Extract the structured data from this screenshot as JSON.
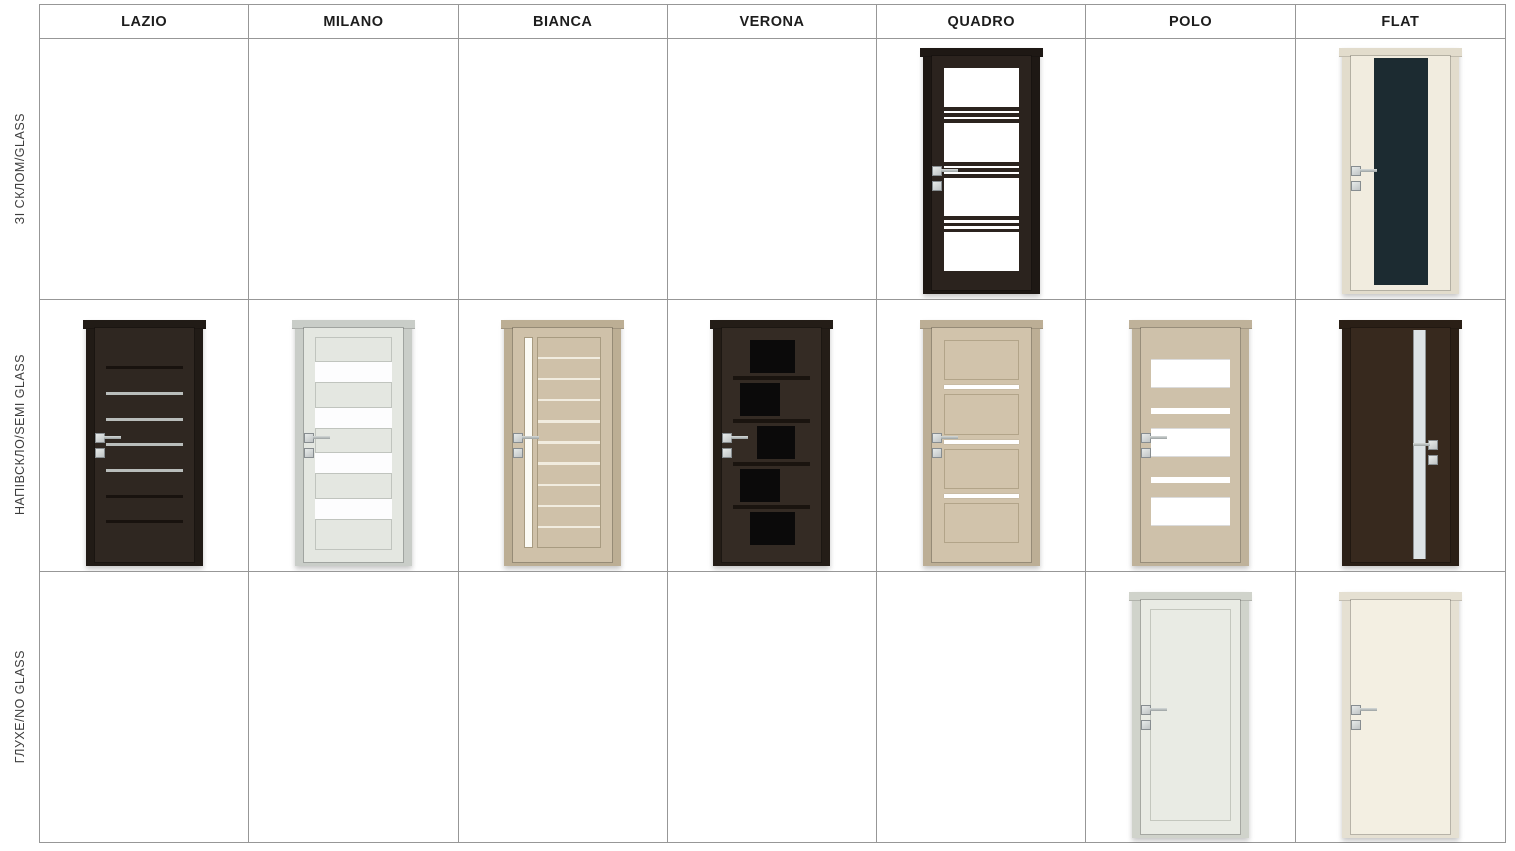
{
  "page": {
    "background": "#ffffff",
    "table_border": "#979797",
    "header_text_color": "#1d1d1d",
    "label_text_color": "#3d3d3d"
  },
  "table": {
    "columns": [
      {
        "key": "lazio",
        "label": "LAZIO"
      },
      {
        "key": "milano",
        "label": "MILANO"
      },
      {
        "key": "bianca",
        "label": "BIANCA"
      },
      {
        "key": "verona",
        "label": "VERONA"
      },
      {
        "key": "quadro",
        "label": "QUADRO"
      },
      {
        "key": "polo",
        "label": "POLO"
      },
      {
        "key": "flat",
        "label": "FLAT"
      }
    ],
    "rows": [
      {
        "key": "glass",
        "label": "ЗІ СКЛОМ/GLASS"
      },
      {
        "key": "semi-glass",
        "label": "НАПІВСКЛО/SEMI GLASS"
      },
      {
        "key": "no-glass",
        "label": "ГЛУХЕ/NO GLASS"
      }
    ]
  },
  "doors": [
    {
      "id": "quadro-glass",
      "model": "QUADRO",
      "variant": "glass",
      "row": 0,
      "col": 4,
      "pattern": "quadro-glass",
      "handle_side": "left",
      "handle_top": 47,
      "colors": {
        "frame": "#1e1814",
        "body": "#2b231e",
        "glass": "#ffffff",
        "trim": "#171310"
      }
    },
    {
      "id": "flat-glass",
      "model": "FLAT",
      "variant": "glass",
      "row": 0,
      "col": 6,
      "pattern": "flat-glass",
      "handle_side": "left",
      "handle_top": 47,
      "colors": {
        "frame": "#e2dccc",
        "body": "#f1ecdf",
        "glass": "#1c2b31"
      },
      "detail": {
        "glass_left_pct": 23,
        "glass_width_pct": 55
      }
    },
    {
      "id": "lazio-semi",
      "model": "LAZIO",
      "variant": "semi-glass",
      "row": 1,
      "col": 0,
      "pattern": "lazio",
      "handle_side": "left",
      "handle_top": 45,
      "colors": {
        "frame": "#211b16",
        "body": "#2f2721",
        "glass": "#b9bdbb",
        "groove": "#18120e"
      },
      "detail": {
        "gaps": [
          "dark",
          "light",
          "light",
          "light",
          "light",
          "dark",
          "dark"
        ]
      }
    },
    {
      "id": "milano-semi",
      "model": "MILANO",
      "variant": "semi-glass",
      "row": 1,
      "col": 1,
      "pattern": "milano",
      "handle_side": "left",
      "handle_top": 45,
      "colors": {
        "frame": "#c9cdc8",
        "body": "#e4e7e1",
        "glass": "#fdfdfe",
        "trim": "#c0c4be"
      },
      "detail": {
        "bands": [
          "panel",
          "glass",
          "panel",
          "glass",
          "panel",
          "glass",
          "panel",
          "glass",
          "panel"
        ],
        "flex": [
          1.15,
          1,
          1.2,
          1,
          1.2,
          1,
          1.2,
          1,
          1.45
        ]
      }
    },
    {
      "id": "bianca-semi",
      "model": "BIANCA",
      "variant": "semi-glass",
      "row": 1,
      "col": 2,
      "pattern": "bianca",
      "handle_side": "left",
      "handle_top": 45,
      "colors": {
        "frame": "#bcae94",
        "body": "#cfc1a9",
        "glass": "#fbfaf4",
        "trim": "#a89b81",
        "stripe": "#f1ecdf"
      },
      "detail": {
        "slats": 10,
        "strip_width": 9
      }
    },
    {
      "id": "verona-semi",
      "model": "VERONA",
      "variant": "semi-glass",
      "row": 1,
      "col": 3,
      "pattern": "verona",
      "handle_side": "left",
      "handle_top": 45,
      "colors": {
        "frame": "#241d17",
        "body": "#342b24",
        "glass": "#0b0a0a",
        "groove": "#1a140f"
      },
      "detail": {
        "bands": [
          {
            "l": 22,
            "w": 58
          },
          {
            "l": 8,
            "w": 52
          },
          {
            "l": 30,
            "w": 50
          },
          {
            "l": 8,
            "w": 52
          },
          {
            "l": 22,
            "w": 58
          }
        ]
      }
    },
    {
      "id": "quadro-semi",
      "model": "QUADRO",
      "variant": "semi-glass",
      "row": 1,
      "col": 4,
      "pattern": "quadro-semi",
      "handle_side": "left",
      "handle_top": 45,
      "colors": {
        "frame": "#bcae95",
        "body": "#d1c3ab",
        "glass": "#ffffff",
        "trim": "#b2a489"
      }
    },
    {
      "id": "polo-semi",
      "model": "POLO",
      "variant": "semi-glass",
      "row": 1,
      "col": 5,
      "pattern": "polo",
      "handle_side": "left",
      "handle_top": 45,
      "colors": {
        "frame": "#bfb29a",
        "body": "#cec1aa",
        "glass": "#ffffff"
      },
      "detail": {
        "segments": [
          [
            "wood",
            0.9
          ],
          [
            "glass",
            1.05
          ],
          [
            "wood",
            0.75
          ],
          [
            "stripe",
            0.24
          ],
          [
            "wood",
            0.5
          ],
          [
            "glass",
            1.05
          ],
          [
            "wood",
            0.75
          ],
          [
            "stripe",
            0.24
          ],
          [
            "wood",
            0.5
          ],
          [
            "glass",
            1.05
          ],
          [
            "wood",
            1.05
          ]
        ]
      }
    },
    {
      "id": "flat-semi",
      "model": "FLAT",
      "variant": "semi-glass",
      "row": 1,
      "col": 6,
      "pattern": "flat-strip",
      "handle_side": "right",
      "handle_top": 48,
      "colors": {
        "frame": "#2a1f16",
        "body": "#37291e",
        "glass": "#dde3e6"
      },
      "detail": {
        "strip_left_pct": 63,
        "strip_width_pct": 13,
        "handle_left_pct": 78
      }
    },
    {
      "id": "polo-no-glass",
      "model": "POLO",
      "variant": "no-glass",
      "row": 2,
      "col": 5,
      "pattern": "panel",
      "handle_side": "left",
      "handle_top": 45,
      "colors": {
        "frame": "#d0d3cb",
        "body": "#e9ebe4",
        "trim": "#c4c7be"
      }
    },
    {
      "id": "flat-no-glass",
      "model": "FLAT",
      "variant": "no-glass",
      "row": 2,
      "col": 6,
      "pattern": "plain",
      "handle_side": "left",
      "handle_top": 45,
      "colors": {
        "frame": "#e5e0d2",
        "body": "#f3efe2"
      }
    }
  ]
}
